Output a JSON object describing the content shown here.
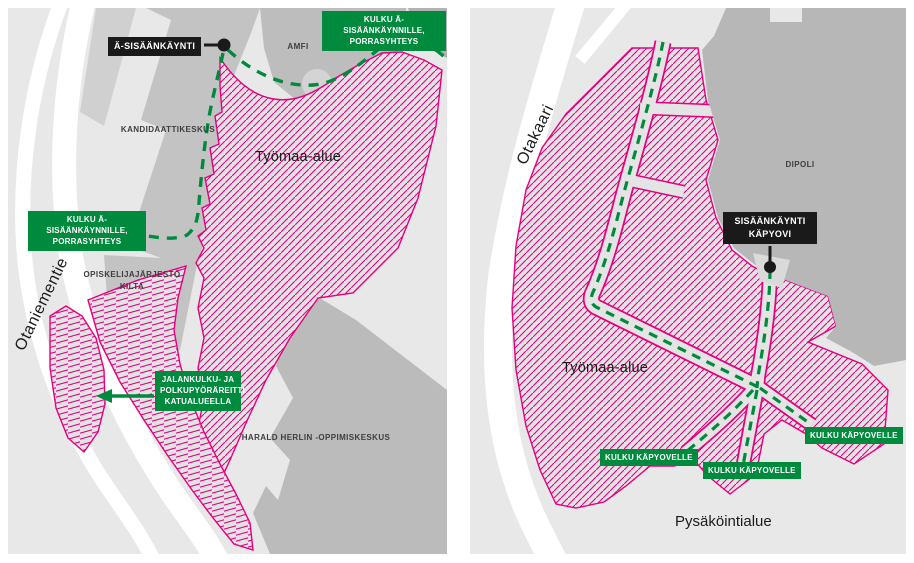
{
  "colors": {
    "map_background": "#e8e8e8",
    "road_white": "#ffffff",
    "building_gray": "#c3c3c3",
    "building_dark_gray": "#b7b7b7",
    "work_area_pink": "#e6007e",
    "route_green": "#008a3d",
    "entrance_label_black": "#1a1a1a",
    "label_text_white": "#ffffff"
  },
  "left_map": {
    "street_label": "Otaniementie",
    "entrance_label": "Ä-SISÄÄNKÄYNTI",
    "work_area_label": "Työmaa-alue",
    "building_labels": {
      "amfi": "AMFI",
      "kandidaattikeskus": "KANDIDAATTIKESKUS",
      "kilta": "OPISKELIJAJÄRJESTÖ\nKILTA",
      "harald_herlin": "HARALD HERLIN -OPPIMISKESKUS"
    },
    "route_labels": {
      "access_top": "KULKU Ä-SISÄÄNKÄYNNILLE,\nPORRASYHTEYS",
      "access_left": "KULKU Ä-SISÄÄNKÄYNNILLE,\nPORRASYHTEYS",
      "pedestrian_route": "JALANKULKU- JA\nPOLKUPYÖRÄREITTI\nKATUALUEELLA"
    }
  },
  "right_map": {
    "street_label": "Otakaari",
    "entrance_label": "SISÄÄNKÄYNTI\nKÄPYOVI",
    "work_area_label": "Työmaa-alue",
    "parking_label": "Pysäköintialue",
    "building_labels": {
      "dipoli": "DIPOLI"
    },
    "route_labels": {
      "kapyovi_left": "KULKU KÄPYOVELLE",
      "kapyovi_middle": "KULKU KÄPYOVELLE",
      "kapyovi_right": "KULKU KÄPYOVELLE"
    }
  }
}
